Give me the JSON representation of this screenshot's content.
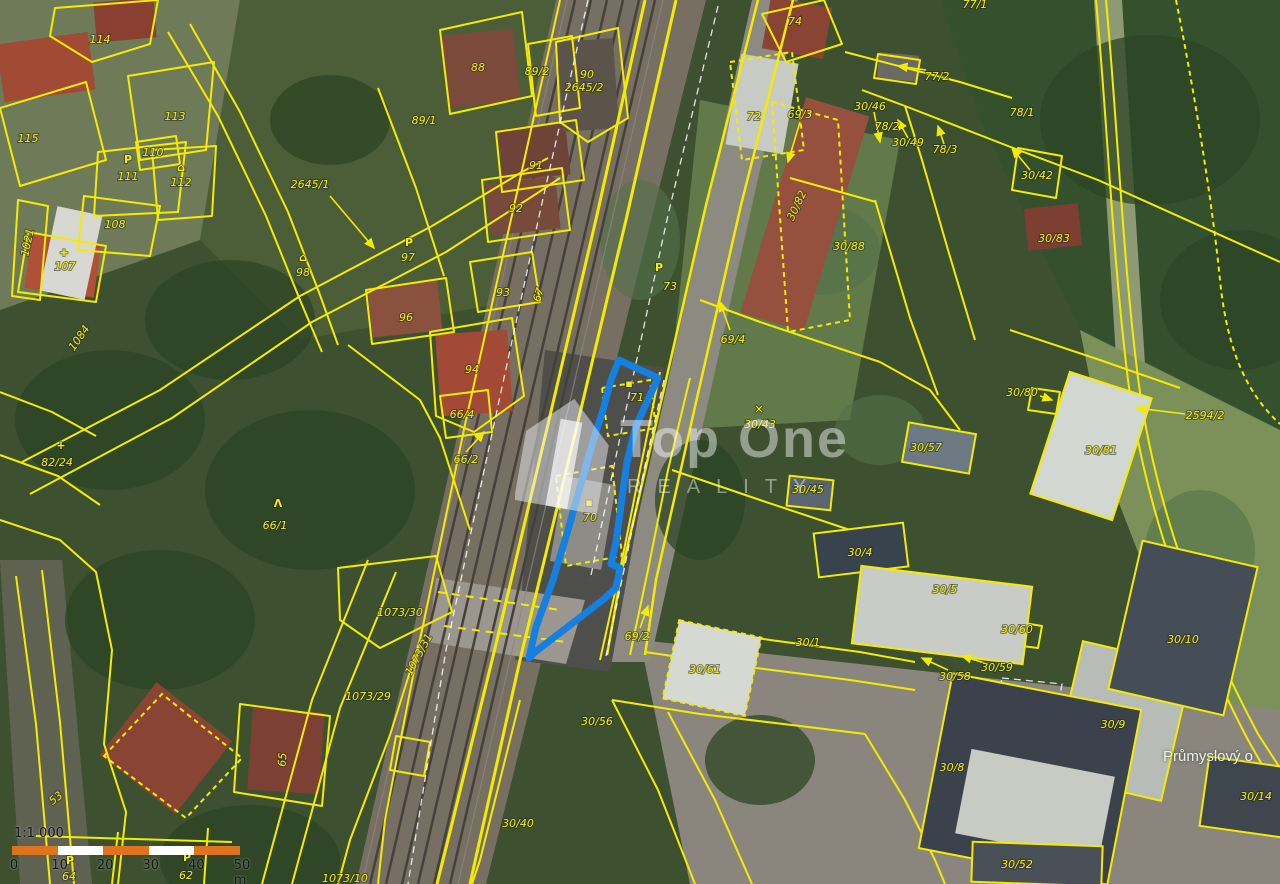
{
  "map": {
    "colors": {
      "boundary_yellow": "#f4ec00",
      "highlight_blue": "#1580e0",
      "scalebar_orange": "#e0731d",
      "scalebar_white": "#ffffff"
    },
    "watermark": {
      "title": "Top One",
      "subtitle": "REALITY",
      "logo": "house-logo"
    },
    "scale_bar": {
      "ratio_label": "1:1 000",
      "tick_labels": [
        "0",
        "10",
        "20",
        "30",
        "40",
        "50 m"
      ],
      "segment_meters": 10,
      "segments": 5
    },
    "area_labels": [
      {
        "t": "Průmyslový o",
        "x": 1163,
        "y": 748
      }
    ],
    "highlighted_parcel": {
      "numbers": [
        "71",
        "70"
      ]
    },
    "parcel_labels": [
      {
        "t": "114",
        "x": 100,
        "y": 43
      },
      {
        "t": "115",
        "x": 28,
        "y": 142
      },
      {
        "t": "113",
        "x": 175,
        "y": 120
      },
      {
        "t": "110",
        "x": 153,
        "y": 156
      },
      {
        "t": "111",
        "x": 128,
        "y": 180
      },
      {
        "t": "112",
        "x": 181,
        "y": 186
      },
      {
        "t": "108",
        "x": 115,
        "y": 228
      },
      {
        "t": "107",
        "x": 65,
        "y": 270
      },
      {
        "t": "1021",
        "x": 31,
        "y": 243,
        "r": -78
      },
      {
        "t": "88",
        "x": 478,
        "y": 71
      },
      {
        "t": "89/2",
        "x": 537,
        "y": 75
      },
      {
        "t": "90",
        "x": 587,
        "y": 78
      },
      {
        "t": "2645/2",
        "x": 584,
        "y": 91
      },
      {
        "t": "89/1",
        "x": 424,
        "y": 124
      },
      {
        "t": "91",
        "x": 536,
        "y": 169
      },
      {
        "t": "92",
        "x": 516,
        "y": 212
      },
      {
        "t": "2645/1",
        "x": 310,
        "y": 188
      },
      {
        "t": "98",
        "x": 303,
        "y": 276
      },
      {
        "t": "97",
        "x": 408,
        "y": 261
      },
      {
        "t": "96",
        "x": 406,
        "y": 321
      },
      {
        "t": "93",
        "x": 503,
        "y": 296
      },
      {
        "t": "94",
        "x": 472,
        "y": 373
      },
      {
        "t": "66/4",
        "x": 462,
        "y": 418
      },
      {
        "t": "66/2",
        "x": 466,
        "y": 463
      },
      {
        "t": "67",
        "x": 542,
        "y": 296,
        "r": -72
      },
      {
        "t": "73",
        "x": 670,
        "y": 290
      },
      {
        "t": "71",
        "x": 637,
        "y": 401
      },
      {
        "t": "70",
        "x": 590,
        "y": 521
      },
      {
        "t": "69/4",
        "x": 733,
        "y": 343
      },
      {
        "t": "69/3",
        "x": 800,
        "y": 118
      },
      {
        "t": "72",
        "x": 754,
        "y": 120
      },
      {
        "t": "74",
        "x": 795,
        "y": 25
      },
      {
        "t": "77/1",
        "x": 975,
        "y": 8
      },
      {
        "t": "77/2",
        "x": 937,
        "y": 80
      },
      {
        "t": "30/46",
        "x": 870,
        "y": 110
      },
      {
        "t": "78/2",
        "x": 887,
        "y": 130
      },
      {
        "t": "30/49",
        "x": 908,
        "y": 146
      },
      {
        "t": "78/3",
        "x": 945,
        "y": 153
      },
      {
        "t": "78/1",
        "x": 1022,
        "y": 116
      },
      {
        "t": "30/42",
        "x": 1037,
        "y": 179
      },
      {
        "t": "30/83",
        "x": 1054,
        "y": 242
      },
      {
        "t": "30/82",
        "x": 800,
        "y": 207,
        "r": -65
      },
      {
        "t": "30/88",
        "x": 849,
        "y": 250
      },
      {
        "t": "30/80",
        "x": 1022,
        "y": 396
      },
      {
        "t": "2594/2",
        "x": 1205,
        "y": 419
      },
      {
        "t": "30/81",
        "x": 1101,
        "y": 454
      },
      {
        "t": "30/43",
        "x": 760,
        "y": 428
      },
      {
        "t": "30/4",
        "x": 860,
        "y": 556
      },
      {
        "t": "30/5",
        "x": 945,
        "y": 593
      },
      {
        "t": "30/45",
        "x": 808,
        "y": 493
      },
      {
        "t": "30/57",
        "x": 926,
        "y": 451
      },
      {
        "t": "69/2",
        "x": 637,
        "y": 640
      },
      {
        "t": "30/56",
        "x": 597,
        "y": 725
      },
      {
        "t": "30/1",
        "x": 808,
        "y": 646
      },
      {
        "t": "30/61",
        "x": 705,
        "y": 673
      },
      {
        "t": "30/58",
        "x": 955,
        "y": 680
      },
      {
        "t": "30/60",
        "x": 1017,
        "y": 633
      },
      {
        "t": "30/59",
        "x": 997,
        "y": 671
      },
      {
        "t": "30/10",
        "x": 1183,
        "y": 643
      },
      {
        "t": "30/9",
        "x": 1113,
        "y": 728
      },
      {
        "t": "30/8",
        "x": 952,
        "y": 771
      },
      {
        "t": "30/14",
        "x": 1256,
        "y": 800
      },
      {
        "t": "30/52",
        "x": 1017,
        "y": 868
      },
      {
        "t": "1073/30",
        "x": 400,
        "y": 616
      },
      {
        "t": "1073/31",
        "x": 422,
        "y": 656,
        "r": -62
      },
      {
        "t": "1073/29",
        "x": 368,
        "y": 700
      },
      {
        "t": "30/40",
        "x": 518,
        "y": 827
      },
      {
        "t": "53",
        "x": 58,
        "y": 801,
        "r": -38
      },
      {
        "t": "65",
        "x": 286,
        "y": 760,
        "r": -85
      },
      {
        "t": "64",
        "x": 69,
        "y": 880
      },
      {
        "t": "62",
        "x": 186,
        "y": 879
      },
      {
        "t": "82/24",
        "x": 57,
        "y": 466
      },
      {
        "t": "1084",
        "x": 82,
        "y": 340,
        "r": -55
      },
      {
        "t": "66/1",
        "x": 275,
        "y": 529
      },
      {
        "t": "1073/10",
        "x": 345,
        "y": 882
      }
    ],
    "symbols": [
      {
        "g": "P",
        "x": 128,
        "y": 163
      },
      {
        "g": "⌂",
        "x": 181,
        "y": 171
      },
      {
        "g": "+",
        "x": 64,
        "y": 256
      },
      {
        "g": "P",
        "x": 409,
        "y": 246
      },
      {
        "g": "⌂",
        "x": 303,
        "y": 261
      },
      {
        "g": "+",
        "x": 61,
        "y": 449
      },
      {
        "g": "Λ",
        "x": 278,
        "y": 507
      },
      {
        "g": "P",
        "x": 659,
        "y": 271
      },
      {
        "g": "✕",
        "x": 759,
        "y": 413
      },
      {
        "g": "P",
        "x": 70,
        "y": 864
      },
      {
        "g": "P",
        "x": 187,
        "y": 861
      },
      {
        "g": "▪",
        "x": 629,
        "y": 387
      },
      {
        "g": "▪",
        "x": 589,
        "y": 506
      }
    ]
  }
}
